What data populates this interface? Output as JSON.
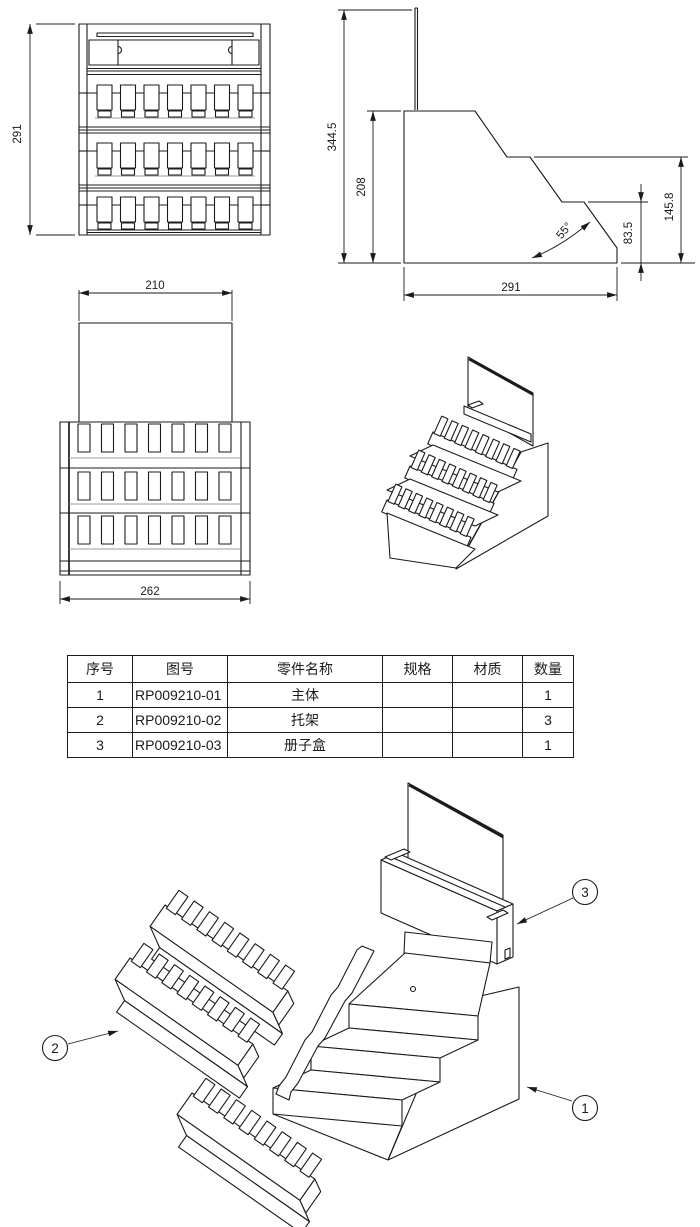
{
  "drawing": {
    "front_view": {
      "dim_height": "291"
    },
    "side_view": {
      "dim_total_height": "344.5",
      "dim_body_height": "208",
      "dim_angle": "55°",
      "dim_lower_step": "83.5",
      "dim_upper_step": "145.8",
      "dim_depth": "291"
    },
    "top_view": {
      "dim_panel_width": "210",
      "dim_body_width": "262"
    }
  },
  "bom_table": {
    "headers": [
      "序号",
      "图号",
      "零件名称",
      "规格",
      "材质",
      "数量"
    ],
    "rows": [
      {
        "no": "1",
        "drawing_no": "RP009210-01",
        "part_name": "主体",
        "spec": "",
        "material": "",
        "qty": "1"
      },
      {
        "no": "2",
        "drawing_no": "RP009210-02",
        "part_name": "托架",
        "spec": "",
        "material": "",
        "qty": "3"
      },
      {
        "no": "3",
        "drawing_no": "RP009210-03",
        "part_name": "册子盒",
        "spec": "",
        "material": "",
        "qty": "1"
      }
    ]
  },
  "exploded_view": {
    "balloons": [
      {
        "label": "1"
      },
      {
        "label": "2"
      },
      {
        "label": "3"
      }
    ]
  },
  "colors": {
    "line": "#1b1b1b",
    "shadow": "#9b9b9b",
    "background": "#ffffff"
  }
}
